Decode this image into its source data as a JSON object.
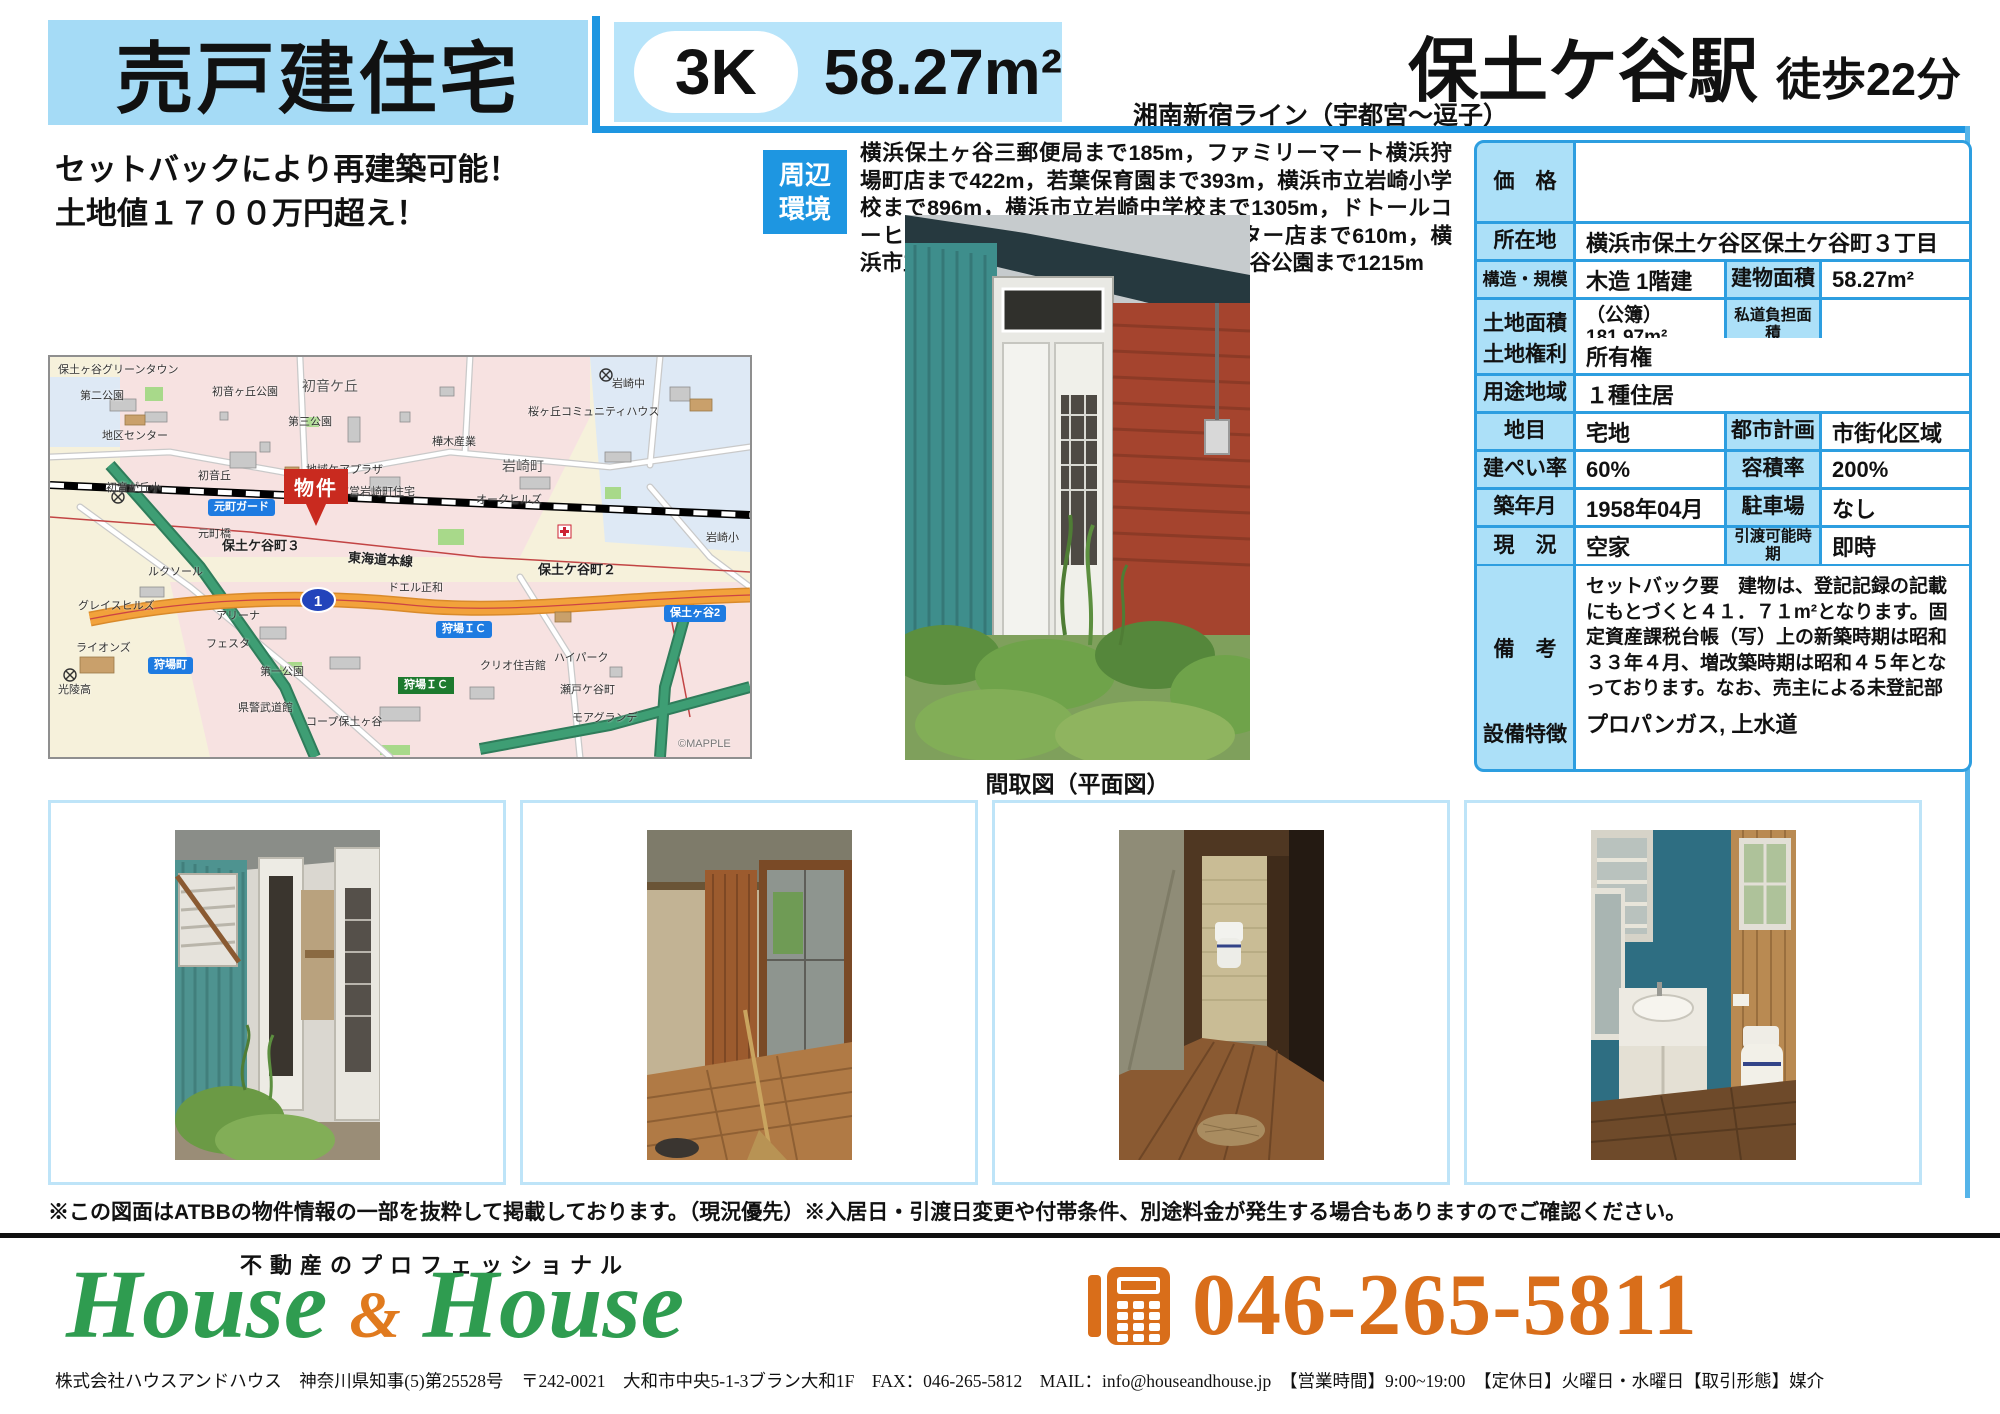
{
  "header": {
    "property_type": "売戸建住宅",
    "layout": "3K",
    "area": "58.27m²",
    "line": "湘南新宿ライン（宇都宮～逗子）",
    "station": "保土ケ谷駅",
    "walk": "徒歩22分"
  },
  "headline": {
    "line1": "セットバックにより再建築可能！",
    "line2": "土地値１７００万円超え！"
  },
  "surroundings": {
    "badge": "周辺環境",
    "text": "横浜保土ヶ谷三郵便局まで185m，ファミリーマート横浜狩場町店まで422m，若葉保育園まで393m，横浜市立岩崎小学校まで896m，横浜市立岩崎中学校まで1305m，ドトールコーヒーショップＥｎｅＪｅｔ狩場インター店まで610m，横浜市立桜丘高校まで1316m，県立保土ケ谷公園まで1215m"
  },
  "photo_caption": "間取図（平面図）",
  "map": {
    "marker": "物件",
    "badges": [
      {
        "t": "元町ガード"
      },
      {
        "t": "狩場町"
      },
      {
        "t": "狩場ＩＣ"
      },
      {
        "t": "狩場ＩＣ"
      },
      {
        "t": "保土ヶ谷2"
      }
    ],
    "route_shield": "1",
    "labels": [
      {
        "t": "保土ヶ谷グリーンタウン"
      },
      {
        "t": "第二公園"
      },
      {
        "t": "地区センター"
      },
      {
        "t": "初音ヶ丘公園"
      },
      {
        "t": "初音ケ丘"
      },
      {
        "t": "第三公園"
      },
      {
        "t": "岩崎中"
      },
      {
        "t": "桜ヶ丘コミュニティハウス"
      },
      {
        "t": "樺木産業"
      },
      {
        "t": "岩崎町"
      },
      {
        "t": "初音が丘小"
      },
      {
        "t": "初音丘"
      },
      {
        "t": "地域ケアプラザ"
      },
      {
        "t": "市営岩崎町住宅"
      },
      {
        "t": "オークヒルズ"
      },
      {
        "t": "岩崎小"
      },
      {
        "t": "元町橋"
      },
      {
        "t": "保土ケ谷町３"
      },
      {
        "t": "東海道本線"
      },
      {
        "t": "保土ケ谷町２"
      },
      {
        "t": "ドエル正和"
      },
      {
        "t": "ルクソール"
      },
      {
        "t": "グレイスヒルズ"
      },
      {
        "t": "ライオンズ"
      },
      {
        "t": "光陵高"
      },
      {
        "t": "アリーナ"
      },
      {
        "t": "フェスタ"
      },
      {
        "t": "第一公園"
      },
      {
        "t": "県警武道館"
      },
      {
        "t": "コープ保土ヶ谷"
      },
      {
        "t": "クリオ住吉館"
      },
      {
        "t": "ハイパーク"
      },
      {
        "t": "瀬戸ケ谷町"
      },
      {
        "t": "モアグランデ"
      },
      {
        "t": "©MAPPLE"
      }
    ]
  },
  "table": {
    "rows": [
      {
        "label": "価　格",
        "value": ""
      },
      {
        "label": "所在地",
        "value": "横浜市保土ケ谷区保土ケ谷町３丁目"
      },
      {
        "label": "構造・規模",
        "value": "木造 1階建",
        "label2": "建物面積",
        "value2": "58.27m²"
      },
      {
        "label": "土地面積",
        "value": "（公簿）181.97m²",
        "label2": "私道負担面積",
        "value2": ""
      },
      {
        "label": "土地権利",
        "value": "所有権"
      },
      {
        "label": "用途地域",
        "value": "１種住居"
      },
      {
        "label": "地目",
        "value": "宅地",
        "label2": "都市計画",
        "value2": "市街化区域"
      },
      {
        "label": "建ぺい率",
        "value": "60%",
        "label2": "容積率",
        "value2": "200%"
      },
      {
        "label": "築年月",
        "value": "1958年04月",
        "label2": "駐車場",
        "value2": "なし"
      },
      {
        "label": "現　況",
        "value": "空家",
        "label2": "引渡可能時期",
        "value2": "即時"
      },
      {
        "label": "備　考",
        "value": "セットバック要　建物は、登記記録の記載にもとづくと４１．７１m²となります。固定資産課税台帳（写）上の新築時期は昭和３３年４月、増改築時期は昭和４５年となっております。なお、売主による未登記部分の表示変更登記は行いません。"
      },
      {
        "label": "設備特徴",
        "value": "プロパンガス, 上水道"
      }
    ]
  },
  "disclaimer": "※この図面はATBBの物件情報の一部を抜粋して掲載しております。（現況優先）※入居日・引渡日変更や付帯条件、別途料金が発生する場合もありますのでご確認ください。",
  "footer": {
    "tagline": "不動産のプロフェッショナル",
    "brand_left": "House",
    "brand_amp": "&",
    "brand_right": "House",
    "phone": "046-265-5811",
    "info": "株式会社ハウスアンドハウス　神奈川県知事(5)第25528号　〒242-0021　大和市中央5-1-3ブラン大和1F　FAX：046-265-5812　MAIL：info@houseandhouse.jp　【営業時間】9:00~19:00　【定休日】火曜日・水曜日【取引形態】媒介"
  }
}
